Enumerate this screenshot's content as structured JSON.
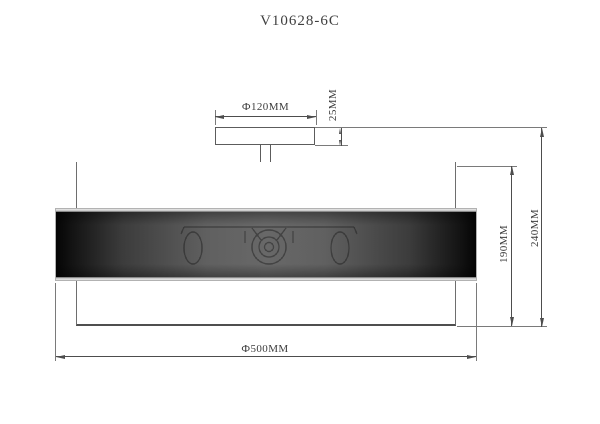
{
  "title": "V10628-6C",
  "drawing": {
    "dimensions": {
      "canopy_diameter": "Ф120MM",
      "canopy_height": "25MM",
      "shade_height": "190MM",
      "overall_height": "240MM",
      "shade_diameter": "Ф500MM"
    },
    "colors": {
      "object_line": "#5c5c5c",
      "dimension_line": "#4d4d4d",
      "text": "#3c3c3c",
      "mesh_dark": "#070707",
      "mesh_mid": "#989898",
      "background": "#ffffff"
    }
  }
}
